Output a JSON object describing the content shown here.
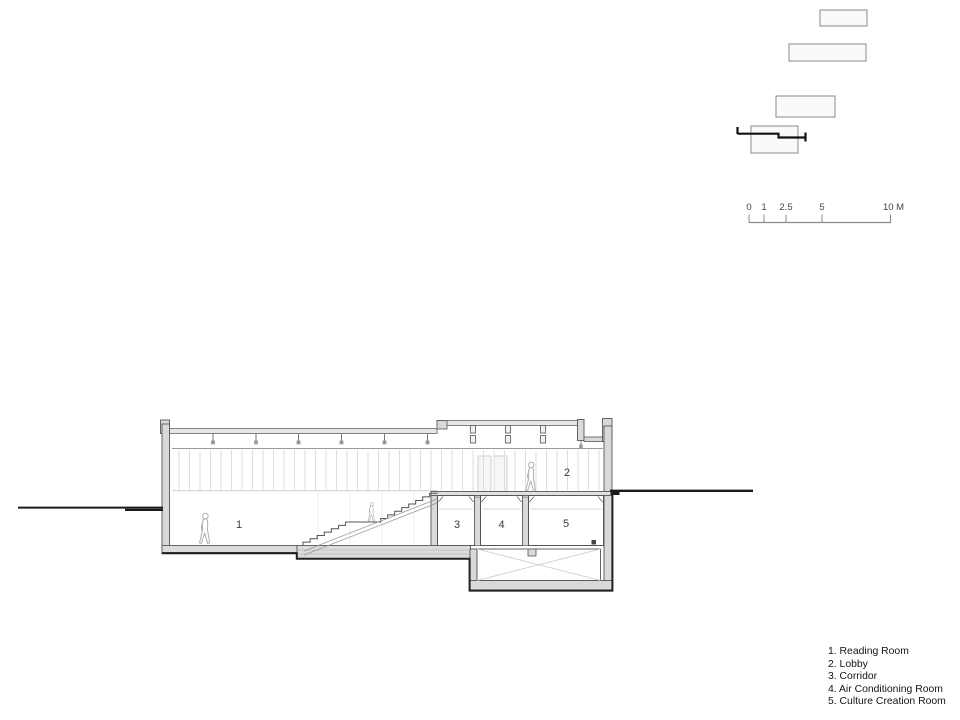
{
  "drawing": {
    "type": "architectural-section",
    "room_numbers": [
      "1",
      "2",
      "3",
      "4",
      "5"
    ]
  },
  "scale_bar": {
    "labels": [
      "0",
      "1",
      "2.5",
      "5",
      "10 M"
    ]
  },
  "legend": {
    "items": [
      "1. Reading Room",
      "2. Lobby",
      "3. Corridor",
      "4. Air Conditioning Room",
      "5. Culture Creation Room"
    ]
  },
  "colors": {
    "background": "#ffffff",
    "ground_line": "#1a1a1a",
    "wall_fill": "#d9d9d9",
    "outline": "#555555",
    "hatch": "#dddddd"
  }
}
